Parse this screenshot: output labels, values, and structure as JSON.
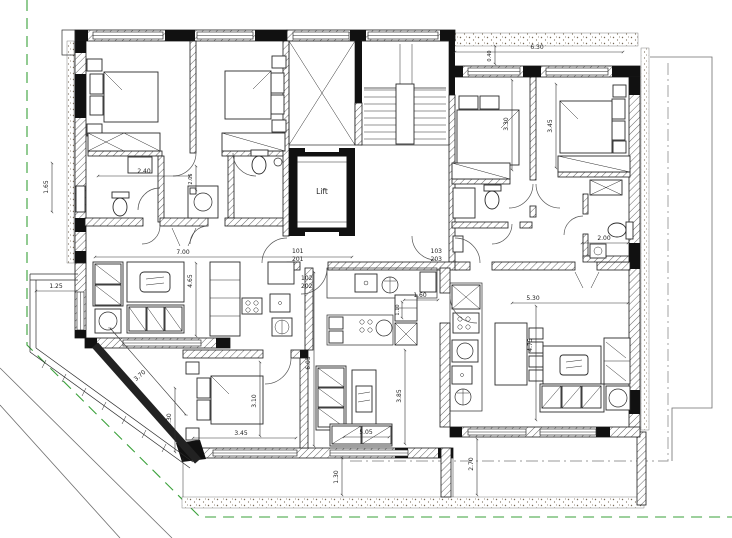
{
  "drawing": {
    "type": "architectural-floor-plan",
    "core": {
      "lift_label": "Lift"
    },
    "unit_numbers": [
      [
        "101",
        "201"
      ],
      [
        "102",
        "202"
      ],
      [
        "103",
        "203"
      ]
    ],
    "colors": {
      "wall": "#111111",
      "hatch": "#666666",
      "boundary_green": "#3aa13a",
      "boundary_gray": "#9a9a9a",
      "stipple": "#756753",
      "dimension_text": "#222222"
    },
    "labels": [
      {
        "text": "Lift",
        "x": 322,
        "y": 194,
        "size": 7.5,
        "name": "lift-label"
      },
      {
        "text": "101",
        "x": 292,
        "y": 253,
        "anchor": "start",
        "name": "unit-label-101"
      },
      {
        "text": "201",
        "x": 292,
        "y": 261,
        "anchor": "start",
        "name": "unit-label-201"
      },
      {
        "text": "103",
        "x": 442,
        "y": 253,
        "anchor": "end",
        "name": "unit-label-103"
      },
      {
        "text": "203",
        "x": 442,
        "y": 261,
        "anchor": "end",
        "name": "unit-label-203"
      },
      {
        "text": "102",
        "x": 301,
        "y": 280,
        "anchor": "start",
        "name": "unit-label-102"
      },
      {
        "text": "202",
        "x": 301,
        "y": 288,
        "anchor": "start",
        "name": "unit-label-202"
      },
      {
        "text": "6.30",
        "x": 537,
        "y": 49
      },
      {
        "text": "0.40",
        "x": 491,
        "y": 56,
        "rot": -90,
        "size": 5
      },
      {
        "text": "3.30",
        "x": 508,
        "y": 124,
        "rot": -90
      },
      {
        "text": "3.45",
        "x": 552,
        "y": 126,
        "rot": -90
      },
      {
        "text": "2.00",
        "x": 604,
        "y": 240
      },
      {
        "text": "2.40",
        "x": 144,
        "y": 173
      },
      {
        "text": "2.05",
        "x": 192,
        "y": 179,
        "rot": -90,
        "size": 5
      },
      {
        "text": "1.65",
        "x": 48,
        "y": 187,
        "rot": -90
      },
      {
        "text": "7.00",
        "x": 183,
        "y": 254
      },
      {
        "text": "1.25",
        "x": 56,
        "y": 288
      },
      {
        "text": "4.65",
        "x": 192,
        "y": 281,
        "rot": -90
      },
      {
        "text": "3.70",
        "x": 141,
        "y": 377,
        "rot": -41
      },
      {
        "text": "5.30",
        "x": 171,
        "y": 420,
        "rot": -90
      },
      {
        "text": "3.45",
        "x": 241,
        "y": 435
      },
      {
        "text": "3.10",
        "x": 256,
        "y": 401,
        "rot": -90
      },
      {
        "text": "6.05",
        "x": 310,
        "y": 363,
        "rot": -90
      },
      {
        "text": "1.30",
        "x": 338,
        "y": 477,
        "rot": -90
      },
      {
        "text": "2.70",
        "x": 473,
        "y": 464,
        "rot": -90
      },
      {
        "text": "1.60",
        "x": 420,
        "y": 297
      },
      {
        "text": "1.10",
        "x": 399,
        "y": 310,
        "rot": -90,
        "size": 5
      },
      {
        "text": "3.85",
        "x": 401,
        "y": 396,
        "rot": -90
      },
      {
        "text": "5.05",
        "x": 366,
        "y": 434
      },
      {
        "text": "5.30",
        "x": 533,
        "y": 300
      },
      {
        "text": "4.75",
        "x": 532,
        "y": 345,
        "rot": -90
      }
    ]
  }
}
